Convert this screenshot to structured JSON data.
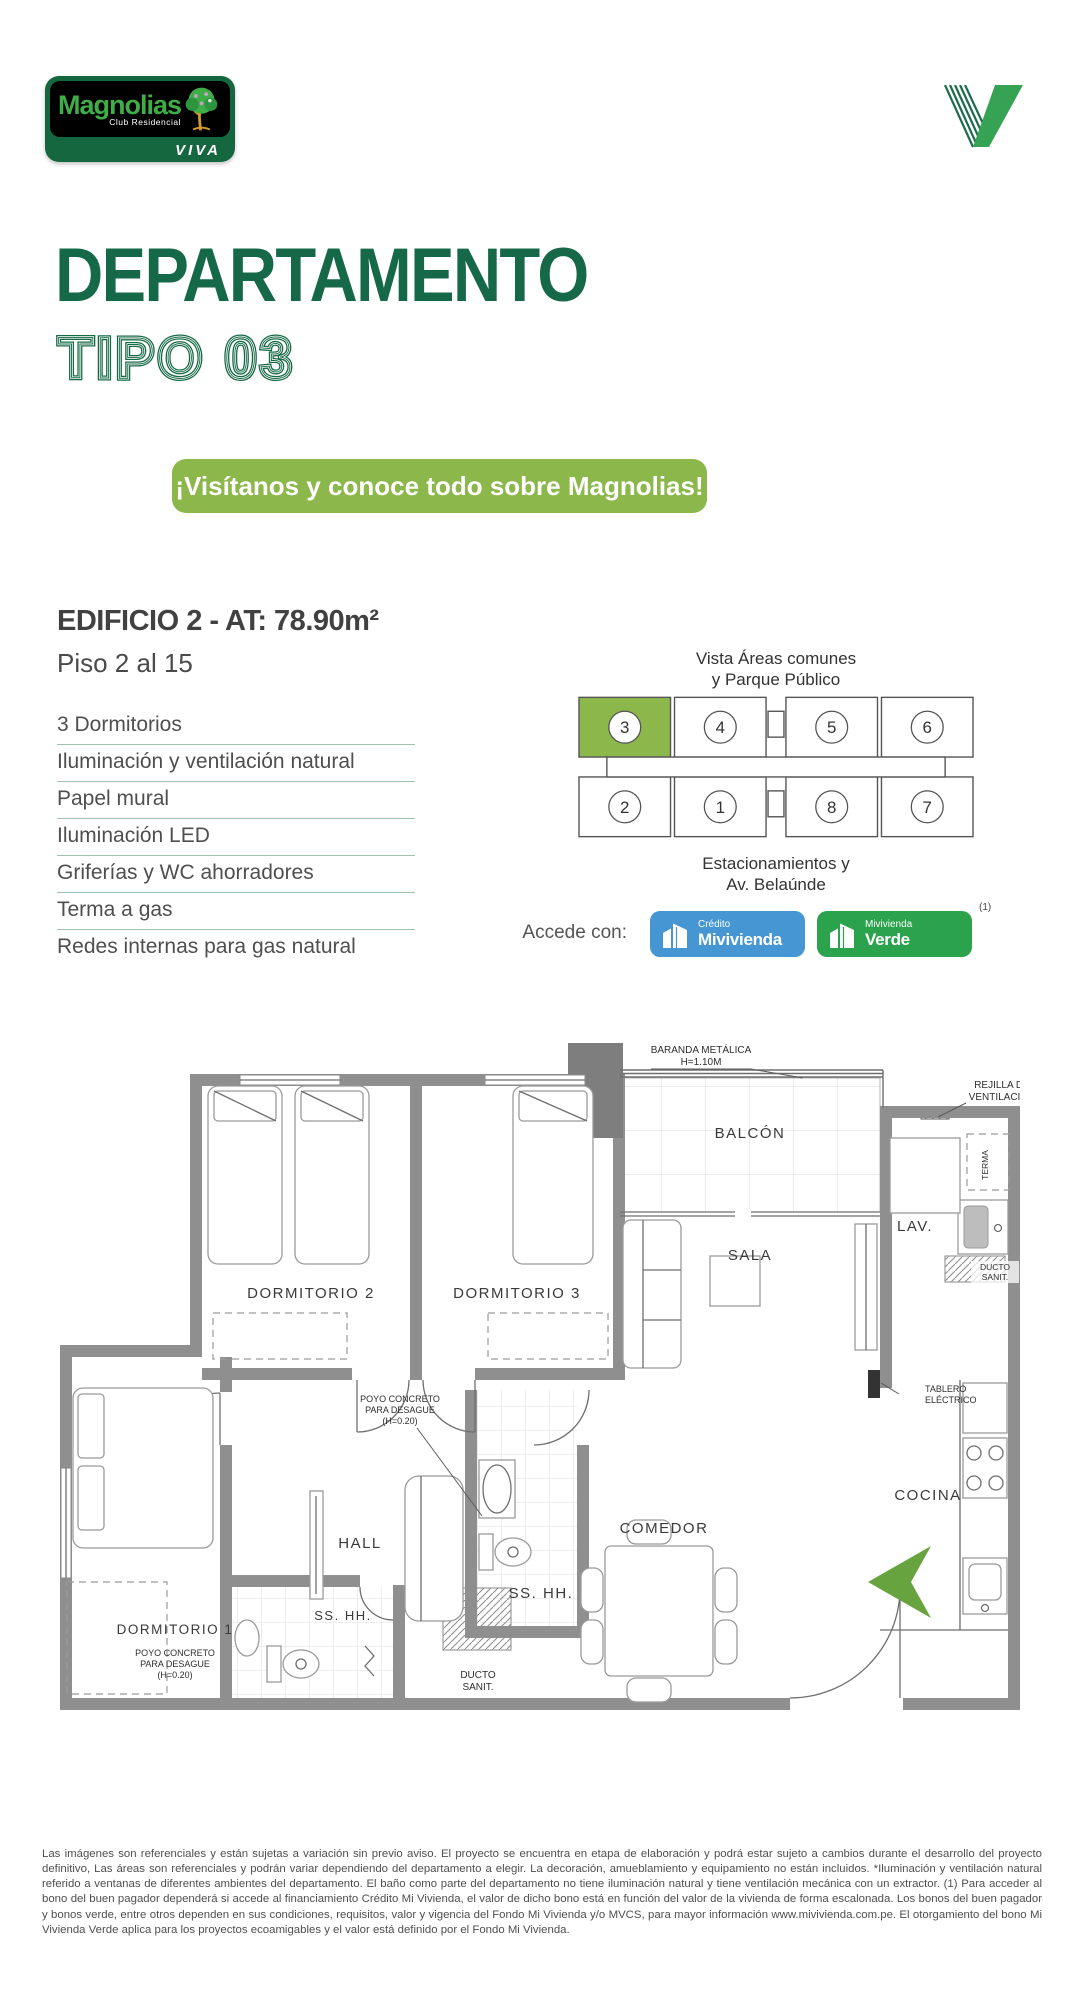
{
  "brand": {
    "name": "Magnolias",
    "subtitle": "Club Residencial",
    "viva": "VIVA"
  },
  "header": {
    "title": "DEPARTAMENTO",
    "subtitle": "TIPO 03"
  },
  "banner": {
    "text": "¡Visítanos y conoce todo sobre Magnolias!"
  },
  "details": {
    "building_title": "EDIFICIO 2 - AT: 78.90m²",
    "floors": "Piso 2 al 15",
    "features": [
      "3 Dormitorios",
      "Iluminación y ventilación natural",
      "Papel mural",
      "Iluminación LED",
      "Griferías y WC ahorradores",
      "Terma a gas",
      "Redes internas para gas natural"
    ]
  },
  "keyplan": {
    "caption_top_1": "Vista Áreas comunes",
    "caption_top_2": "y Parque Público",
    "caption_bottom_1": "Estacionamientos y",
    "caption_bottom_2": "Av. Belaúnde",
    "highlighted_unit": "3",
    "units": [
      "3",
      "4",
      "5",
      "6",
      "2",
      "1",
      "8",
      "7"
    ]
  },
  "financing": {
    "label": "Accede con:",
    "badges": [
      {
        "line1": "Crédito",
        "line2": "Mivivienda"
      },
      {
        "line1": "Mivivienda",
        "line2": "Verde"
      }
    ],
    "note": "(1)"
  },
  "floorplan": {
    "rooms": {
      "balcon": "BALCÓN",
      "lav": "LAV.",
      "sala": "SALA",
      "dormitorio2": "DORMITORIO 2",
      "dormitorio3": "DORMITORIO 3",
      "hall": "HALL",
      "sshh1": "SS. HH.",
      "comedor": "COMEDOR",
      "cocina": "COCINA",
      "dormitorio1": "DORMITORIO 1",
      "sshh2": "SS. HH."
    },
    "annotations": {
      "baranda_1": "BARANDA METÁLICA",
      "baranda_2": "H=1.10M",
      "rejilla_1": "REJILLA DE",
      "rejilla_2": "VENTILACIÓN",
      "terma": "TERMA",
      "ducto_1": "DUCTO",
      "ducto_2": "SANIT.",
      "poyo_1": "POYO CONCRETO",
      "poyo_2": "PARA DESAGUE",
      "poyo_3": "(H=0.20)",
      "tablero_1": "TABLERO",
      "tablero_2": "ELÉCTRICO"
    }
  },
  "footer": {
    "disclaimer": "Las imágenes son referenciales y están sujetas a variación sin previo aviso. El proyecto se encuentra en etapa de elaboración y podrá estar sujeto a cambios durante el desarrollo del proyecto definitivo, Las áreas son referenciales y podrán variar dependiendo del departamento a elegir. La decoración, amueblamiento y equipamiento no están incluidos. *Iluminación y ventilación natural referido a ventanas de diferentes ambientes del departamento. El baño como parte del departamento no tiene iluminación natural y tiene ventilación mecánica con un extractor. (1) Para acceder al bono del buen pagador dependerá si accede al financiamiento Crédito Mi Vivienda, el valor de dicho bono está en función del valor de la vivienda de forma escalonada. Los bonos del buen pagador y bonos verde, entre otros dependen en sus condiciones, requisitos, valor y vigencia del Fondo Mi Vivienda y/o MVCS, para mayor información www.mivivienda.com.pe. El otorgamiento del bono Mi Vivienda Verde aplica para los proyectos ecoamigables y el valor está definido por el Fondo Mi Vivienda."
  },
  "colors": {
    "accent_green": "#166948",
    "banner_green": "#8cb84b",
    "highlight_unit_green": "#8cb84b",
    "badge_blue": "#4596d2",
    "badge_green": "#2aa34c",
    "logo_green": "#3fae49",
    "arrow_green": "#67a33f"
  }
}
